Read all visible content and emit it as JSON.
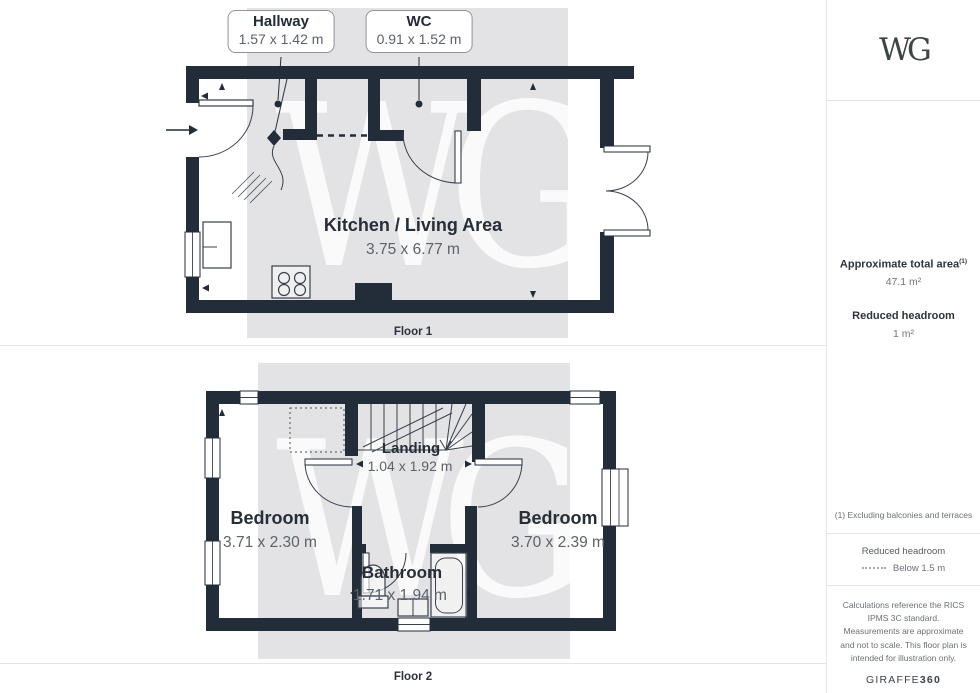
{
  "brand": {
    "logo_text": "WG",
    "watermark_text": "WG",
    "credit_brand": "GIRAFFE",
    "credit_num": "360"
  },
  "floor1": {
    "label": "Floor 1",
    "callout_hallway": {
      "title": "Hallway",
      "dims": "1.57 x 1.42 m"
    },
    "callout_wc": {
      "title": "WC",
      "dims": "0.91 x 1.52 m"
    },
    "kitchen": {
      "name": "Kitchen / Living Area",
      "dims": "3.75 x 6.77 m"
    }
  },
  "floor2": {
    "label": "Floor 2",
    "landing": {
      "name": "Landing",
      "dims": "1.04 x 1.92 m"
    },
    "bedroom_left": {
      "name": "Bedroom",
      "dims": "3.71 x 2.30 m"
    },
    "bedroom_right": {
      "name": "Bedroom",
      "dims": "3.70 x 2.39 m"
    },
    "bathroom": {
      "name": "Bathroom",
      "dims": "1.71 x 1.94 m"
    }
  },
  "sidebar": {
    "total_area_label": "Approximate total area",
    "total_area_footnote_marker": "(1)",
    "total_area_value": "47.1 m²",
    "reduced_headroom_label": "Reduced headroom",
    "reduced_headroom_value": "1 m²",
    "footnote": "(1) Excluding balconies and terraces",
    "legend_title": "Reduced headroom",
    "legend_value": "Below 1.5 m",
    "disclaimer": "Calculations reference the RICS IPMS 3C standard. Measurements are approximate and not to scale. This floor plan is intended for illustration only."
  },
  "colors": {
    "wall": "#232c39",
    "plate": "#e3e3e5",
    "divider": "#e4e4e6"
  }
}
